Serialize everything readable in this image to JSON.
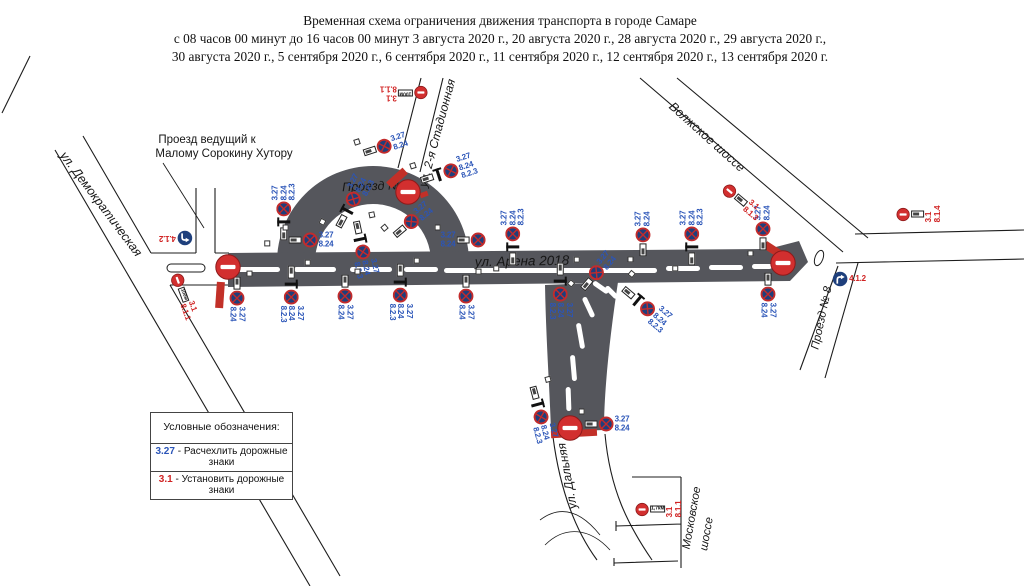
{
  "title": {
    "line1": "Временная схема ограничения движения транспорта в городе Самаре",
    "line2": "с 08 часов 00 минут до 16 часов 00 минут 3 августа 2020 г.,  20 августа 2020 г., 28 августа 2020 г., 29 августа 2020 г.,",
    "line3": "30 августа 2020 г., 5 сентября 2020 г., 6 сентября 2020 г., 11 сентября 2020 г., 12 сентября 2020 г., 13 сентября 2020 г."
  },
  "legend": {
    "header": "Условные обозначения:",
    "items": [
      {
        "code": "3.27",
        "color": "#2b55b8",
        "text": " - Расчехлить дорожные знаки"
      },
      {
        "code": "3.1",
        "color": "#d02222",
        "text": " - Установить дорожные знаки"
      }
    ]
  },
  "colors": {
    "road_dark": "#55565c",
    "sign_blue": "#1e3f7c",
    "sign_red_ring": "#c32b2b",
    "no_entry_red": "#d22f2f",
    "no_entry_dark": "#8d1a1a",
    "label_blue": "#2b55b8",
    "label_red": "#d02222",
    "bar_red": "#c23028"
  },
  "map": {
    "street_labels": [
      {
        "text": "ул. Демократическая",
        "x": 101,
        "y": 204,
        "rot": 53,
        "size": 12.5,
        "italic": true
      },
      {
        "text": "Проезд ведущий к",
        "x": 207,
        "y": 140,
        "rot": 0,
        "size": 11.5,
        "italic": false
      },
      {
        "text": "Малому Сорокину Хутору",
        "x": 224,
        "y": 154,
        "rot": 0,
        "size": 11.5,
        "italic": false
      },
      {
        "text": "ул. 2-я Стадионная",
        "x": 437,
        "y": 133,
        "rot": -75,
        "size": 12,
        "italic": true
      },
      {
        "text": "Проезд № 2",
        "x": 377,
        "y": 186,
        "rot": -2,
        "size": 12.5,
        "italic": true
      },
      {
        "text": "ул. Арена 2018",
        "x": 522,
        "y": 261,
        "rot": -1,
        "size": 13.5,
        "italic": true
      },
      {
        "text": "Волжское шоссе",
        "x": 707,
        "y": 137,
        "rot": 42,
        "size": 12.5,
        "italic": true
      },
      {
        "text": "Проезд № 8",
        "x": 822,
        "y": 318,
        "rot": -78,
        "size": 11.5,
        "italic": true
      },
      {
        "text": "ул. Дальняя",
        "x": 567,
        "y": 476,
        "rot": -100,
        "size": 12,
        "italic": true
      },
      {
        "text": "Московское",
        "x": 692,
        "y": 518,
        "rot": -80,
        "size": 11.5,
        "italic": true
      },
      {
        "text": "шоссе",
        "x": 707,
        "y": 534,
        "rot": -80,
        "size": 11.5,
        "italic": true
      }
    ],
    "sign_clusters": [
      {
        "type": "no_stop",
        "x": 385,
        "y": 146,
        "rot": -18,
        "labels": [
          "3.27",
          "8.24"
        ]
      },
      {
        "type": "no_stop",
        "x": 448,
        "y": 172,
        "rot": -18,
        "labels": [
          "3.27",
          "8.24",
          "8.2.3"
        ],
        "tpost": true
      },
      {
        "type": "no_stop",
        "x": 284,
        "y": 212,
        "rot": -90,
        "labels": [
          "3.27",
          "8.24",
          "8.2.3"
        ],
        "tpost": true
      },
      {
        "type": "no_stop",
        "x": 311,
        "y": 240,
        "rot": 0,
        "labels": [
          "3.27",
          "8.24"
        ]
      },
      {
        "type": "no_stop",
        "x": 352,
        "y": 202,
        "rot": -62,
        "labels": [
          "3.27",
          "8.24",
          "8.2.3"
        ],
        "tpost": true
      },
      {
        "type": "no_stop",
        "x": 362,
        "y": 249,
        "rot": 78,
        "labels": [
          "3.27",
          "8.24",
          "8.2.3"
        ],
        "tpost": true
      },
      {
        "type": "no_stop",
        "x": 412,
        "y": 221,
        "rot": -40,
        "labels": [
          "3.27",
          "8.24"
        ]
      },
      {
        "type": "no_stop",
        "x": 463,
        "y": 240,
        "rot": 0,
        "labels": [
          "3.27",
          "8.24"
        ],
        "side": "left"
      },
      {
        "type": "no_stop",
        "x": 513,
        "y": 237,
        "rot": -90,
        "labels": [
          "3.27",
          "8.24",
          "8.2.3"
        ],
        "tpost": true
      },
      {
        "type": "no_stop",
        "x": 643,
        "y": 234,
        "rot": -90,
        "labels": [
          "3.27",
          "8.24"
        ]
      },
      {
        "type": "no_stop",
        "x": 692,
        "y": 237,
        "rot": -90,
        "labels": [
          "3.27",
          "8.24",
          "8.2.3"
        ],
        "tpost": true
      },
      {
        "type": "no_stop",
        "x": 763,
        "y": 228,
        "rot": -90,
        "labels": [
          "3.27",
          "8.24"
        ]
      },
      {
        "type": "no_stop",
        "x": 597,
        "y": 272,
        "rot": -50,
        "labels": [
          "3.27",
          "8.24"
        ]
      },
      {
        "type": "no_stop",
        "x": 237,
        "y": 299,
        "rot": 90,
        "labels": [
          "3.27",
          "8.24"
        ]
      },
      {
        "type": "no_stop",
        "x": 291,
        "y": 294,
        "rot": 90,
        "labels": [
          "3.27",
          "8.24",
          "8.2.3"
        ],
        "tpost": true
      },
      {
        "type": "no_stop",
        "x": 345,
        "y": 297,
        "rot": 90,
        "labels": [
          "3.27",
          "8.24"
        ]
      },
      {
        "type": "no_stop",
        "x": 400,
        "y": 292,
        "rot": 90,
        "labels": [
          "3.27",
          "8.24",
          "8.2.3"
        ],
        "tpost": true
      },
      {
        "type": "no_stop",
        "x": 466,
        "y": 297,
        "rot": 90,
        "labels": [
          "3.27",
          "8.24"
        ]
      },
      {
        "type": "no_stop",
        "x": 560,
        "y": 291,
        "rot": 90,
        "labels": [
          "3.27",
          "8.24",
          "8.2.3"
        ],
        "tpost": true
      },
      {
        "type": "no_stop",
        "x": 645,
        "y": 307,
        "rot": 40,
        "labels": [
          "3.27",
          "8.24",
          "8.2.3"
        ],
        "tpost": true
      },
      {
        "type": "no_stop",
        "x": 768,
        "y": 295,
        "rot": 90,
        "labels": [
          "3.27",
          "8.24"
        ]
      },
      {
        "type": "no_stop",
        "x": 540,
        "y": 414,
        "rot": 75,
        "labels": [
          "3.27",
          "8.24",
          "8.2.3"
        ],
        "tpost": true
      },
      {
        "type": "no_stop",
        "x": 607,
        "y": 424,
        "rot": 0,
        "labels": [
          "3.27",
          "8.24"
        ]
      },
      {
        "type": "no_entry_small",
        "x": 184,
        "y": 296,
        "rot": 70,
        "labels": [
          "3.1",
          "8.1.1"
        ],
        "plate": "100м"
      },
      {
        "type": "no_entry_small",
        "x": 404,
        "y": 93,
        "rot": 180,
        "labels": [
          "3.1",
          "8.1.1"
        ],
        "plate": "100м"
      },
      {
        "type": "no_entry_small",
        "x": 742,
        "y": 201,
        "rot": 40,
        "labels": [
          "3.1",
          "8.1.3"
        ],
        "plate": ""
      },
      {
        "type": "no_entry_small",
        "x": 919,
        "y": 214,
        "rot": 0,
        "labels": [
          "3.1",
          "8.1.4"
        ],
        "plate": "",
        "label_rot": -90
      },
      {
        "type": "no_entry_small",
        "x": 659,
        "y": 509,
        "rot": 0,
        "labels": [
          "3.1",
          "8.1.1"
        ],
        "plate": "1,7км",
        "label_rot": -90
      },
      {
        "type": "mandatory",
        "x": 176,
        "y": 238,
        "rot": 180,
        "labels": [
          "4.1.2"
        ],
        "dir": "left"
      },
      {
        "type": "mandatory",
        "x": 849,
        "y": 279,
        "rot": 0,
        "labels": [
          "4.1.2"
        ],
        "dir": "right"
      },
      {
        "type": "no_entry_big",
        "x": 228,
        "y": 267,
        "rot": 0,
        "labels": []
      },
      {
        "type": "no_entry_big",
        "x": 408,
        "y": 192,
        "rot": 0,
        "labels": []
      },
      {
        "type": "no_entry_big",
        "x": 783,
        "y": 263,
        "rot": 0,
        "labels": []
      },
      {
        "type": "no_entry_big",
        "x": 570,
        "y": 428,
        "rot": 0,
        "labels": []
      }
    ],
    "closure_bars": [
      {
        "x": 220,
        "y": 295,
        "w": 8,
        "h": 26,
        "rot": 4
      },
      {
        "x": 397,
        "y": 178,
        "w": 8,
        "h": 22,
        "rot": 48
      },
      {
        "x": 424,
        "y": 194,
        "w": 8,
        "h": 5,
        "rot": -20
      },
      {
        "x": 775,
        "y": 251,
        "w": 8,
        "h": 24,
        "rot": -57
      },
      {
        "x": 574,
        "y": 433,
        "w": 46,
        "h": 7,
        "rot": -3
      }
    ]
  }
}
